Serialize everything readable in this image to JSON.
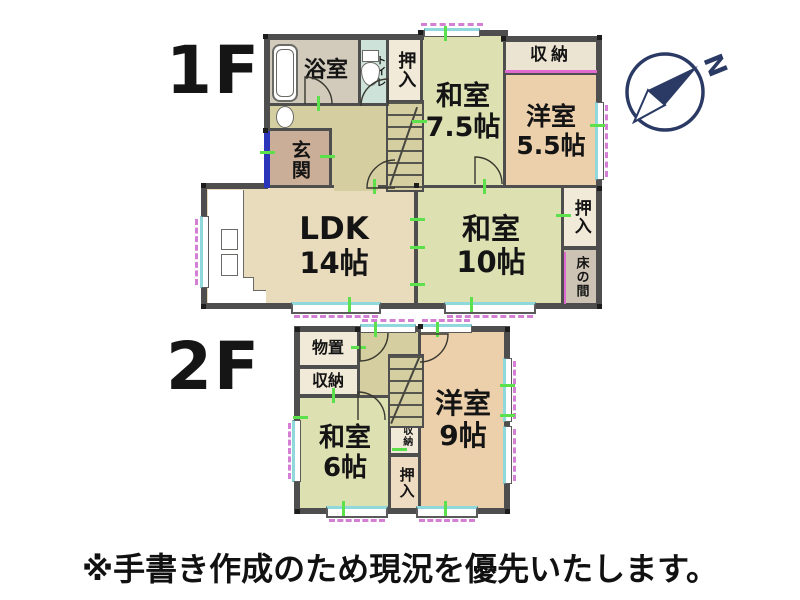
{
  "labels": {
    "floor1": "1F",
    "floor2": "2F"
  },
  "floor1": {
    "bathroom": "浴室",
    "toilet": "トイレ",
    "closet_top": "押入",
    "washitsu_a": {
      "name": "和室",
      "size": "7.5帖"
    },
    "storage_top": "収納",
    "youshitsu_a": {
      "name": "洋室",
      "size": "5.5帖"
    },
    "genkan": "玄関",
    "ldk": {
      "name": "LDK",
      "size": "14帖"
    },
    "washitsu_b": {
      "name": "和室",
      "size": "10帖"
    },
    "closet_right": "押入",
    "tokonoma": "床の間"
  },
  "floor2": {
    "monooki": "物置",
    "storage": "収納",
    "washitsu": {
      "name": "和室",
      "size": "6帖"
    },
    "storage_small": "収納",
    "closet": "押入",
    "youshitsu": {
      "name": "洋室",
      "size": "9帖"
    }
  },
  "compass": {
    "north_letter": "N"
  },
  "caption": "※手書き作成のため現況を優先いたします。",
  "colors": {
    "wall": "#4e4e4e",
    "washitsu_green": "#dde1b2",
    "youshitsu_peach": "#eccfab",
    "ldk_tan": "#e9dcbc",
    "hall_khaki": "#d5cea0",
    "bathroom_gray": "#d2cbbc",
    "toilet_teal": "#cde2d9",
    "genkan_brown": "#cbae97",
    "closet_cream": "#f1ead8",
    "tokonoma_gray": "#cdc3b4",
    "window_cyan": "#8fd8dc",
    "window_pink": "#d27fd4",
    "tick_green": "#5ce04c",
    "compass_navy": "#2a3a64",
    "entry_door_blue": "#2a35bb"
  }
}
